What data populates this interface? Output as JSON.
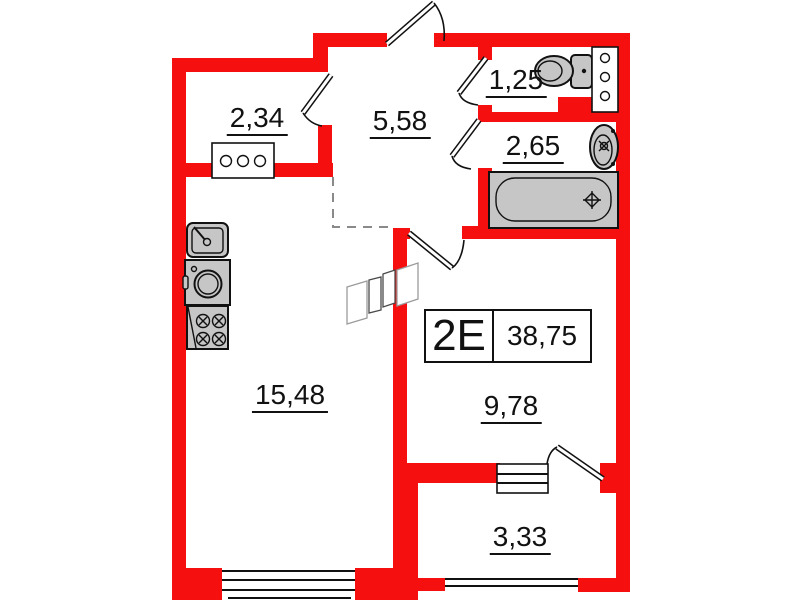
{
  "plan": {
    "unit": {
      "type": "2E",
      "area": "38,75"
    },
    "rooms": [
      {
        "name": "wardrobe",
        "area": "2,34"
      },
      {
        "name": "hallway",
        "area": "5,58"
      },
      {
        "name": "wc",
        "area": "1,25"
      },
      {
        "name": "bathroom",
        "area": "2,65"
      },
      {
        "name": "living-kitchen",
        "area": "15,48"
      },
      {
        "name": "room",
        "area": "9,78"
      },
      {
        "name": "balcony",
        "area": "3,33"
      }
    ],
    "fixtures": [
      "kitchen-sink",
      "washing-machine",
      "stove",
      "cabinet",
      "toilet",
      "vent-shaft",
      "wash-basin",
      "bathtub"
    ],
    "colors": {
      "wall": "#f60f0f",
      "fixture_fill": "#c6c6c6",
      "linework": "#111111",
      "dashed_boundary": "#8a8a8a"
    }
  }
}
